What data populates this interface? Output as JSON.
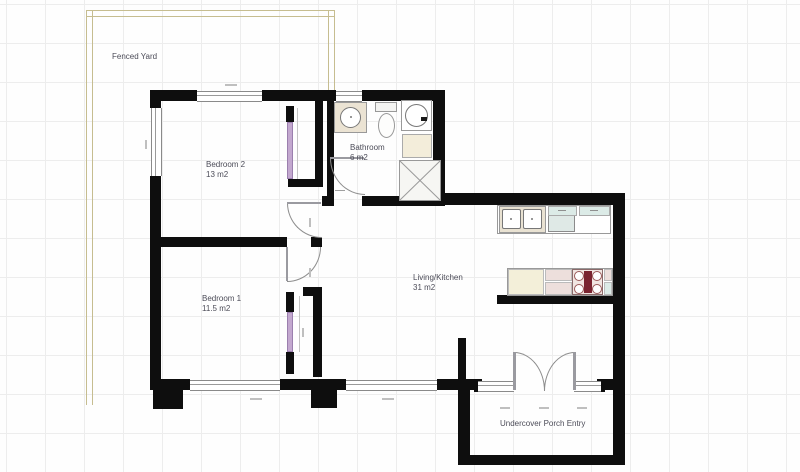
{
  "rooms": {
    "fenced_yard": {
      "name": "Fenced Yard"
    },
    "bedroom2": {
      "name": "Bedroom 2",
      "area": "13 m2"
    },
    "bathroom": {
      "name": "Bathroom",
      "area": "6 m2"
    },
    "bedroom1": {
      "name": "Bedroom 1",
      "area": "11.5 m2"
    },
    "living_kitchen": {
      "name": "Living/Kitchen",
      "area": "31 m2"
    },
    "porch": {
      "name": "Undercover Porch Entry"
    }
  },
  "colors": {
    "wall": "#0e0e0e",
    "fence": "#c6bd90",
    "label_text": "#4c4c58",
    "wardrobe_door": "#c3a8cf",
    "counter_blue": "#dcebe7",
    "counter_cream": "#f3efd9",
    "counter_pink": "#eddfdc",
    "stove_red": "#7a2430"
  }
}
